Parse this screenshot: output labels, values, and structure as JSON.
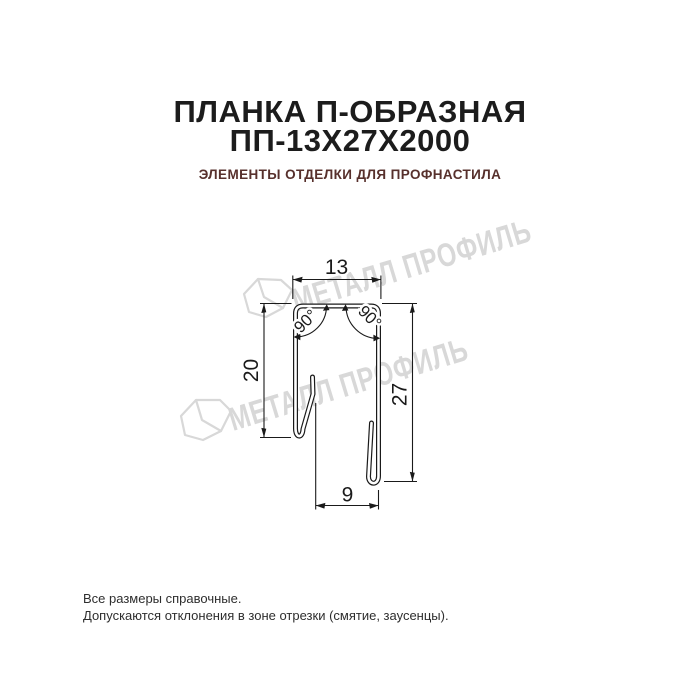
{
  "colors": {
    "background": "#ffffff",
    "title": "#1c1c1c",
    "subtitle": "#57302c",
    "line": "#1a1a1a",
    "watermark": "#d8d8d8",
    "footer": "#2e2e2e"
  },
  "header": {
    "title_line1": "ПЛАНКА П-ОБРАЗНАЯ",
    "title_line2": "ПП-13Х27Х2000",
    "subtitle": "ЭЛЕМЕНТЫ ОТДЕЛКИ ДЛЯ ПРОФНАСТИЛА"
  },
  "drawing": {
    "dimensions": {
      "top_width": "13",
      "left_height": "20",
      "right_height": "27",
      "bottom_width": "9",
      "angle_left": "90°",
      "angle_right": "90°"
    }
  },
  "watermark": {
    "text": "МЕТАЛЛ ПРОФИЛЬ"
  },
  "footer": {
    "line1": "Все размеры справочные.",
    "line2": "Допускаются отклонения в зоне отрезки (смятие, заусенцы)."
  }
}
